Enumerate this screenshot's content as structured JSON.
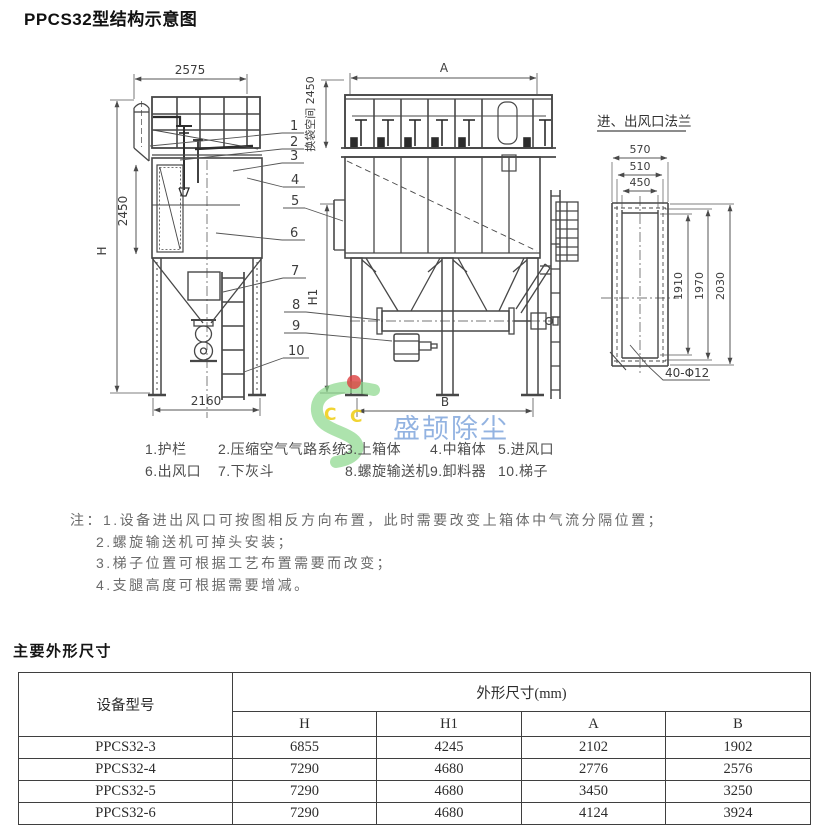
{
  "page": {
    "title": "PPCS32型结构示意图",
    "section_title": "主要外形尺寸"
  },
  "diagram": {
    "flange_title": "进、出风口法兰",
    "labels": {
      "top_width": "2575",
      "bag_space": "换袋空间 2450",
      "side_height": "2450",
      "h": "H",
      "h1": "H1",
      "a": "A",
      "b": "B",
      "base_width": "2160",
      "f570": "570",
      "f510": "510",
      "f450": "450",
      "f1910": "1910",
      "f1970": "1970",
      "f2030": "2030",
      "holes": "40-Φ12"
    },
    "callouts": [
      "1",
      "2",
      "3",
      "4",
      "5",
      "6",
      "7",
      "8",
      "9",
      "10"
    ]
  },
  "legend": {
    "items": [
      "1.护栏",
      "2.压缩空气气路系统",
      "3.上箱体",
      "4.中箱体",
      "5.进风口",
      "6.出风口",
      "7.下灰斗",
      "8.螺旋输送机",
      "9.卸料器",
      "10.梯子"
    ]
  },
  "notes": {
    "prefix": "注：",
    "items": [
      "1.设备进出风口可按图相反方向布置，此时需要改变上箱体中气流分隔位置；",
      "2.螺旋输送机可掉头安装；",
      "3.梯子位置可根据工艺布置需要而改变；",
      "4.支腿高度可根据需要增减。"
    ]
  },
  "watermark": {
    "text": "盛颉除尘",
    "letters": [
      "C",
      "C"
    ],
    "text_color": "#6f9ad8",
    "logo_green": "#86d586",
    "logo_yellow": "#f0d01e",
    "logo_red": "#dd4040"
  },
  "table": {
    "col_model": "设备型号",
    "col_dims": "外形尺寸(mm)",
    "sub_cols": [
      "H",
      "H1",
      "A",
      "B"
    ],
    "rows": [
      {
        "model": "PPCS32-3",
        "values": [
          "6855",
          "4245",
          "2102",
          "1902"
        ]
      },
      {
        "model": "PPCS32-4",
        "values": [
          "7290",
          "4680",
          "2776",
          "2576"
        ]
      },
      {
        "model": "PPCS32-5",
        "values": [
          "7290",
          "4680",
          "3450",
          "3250"
        ]
      },
      {
        "model": "PPCS32-6",
        "values": [
          "7290",
          "4680",
          "4124",
          "3924"
        ]
      }
    ]
  }
}
